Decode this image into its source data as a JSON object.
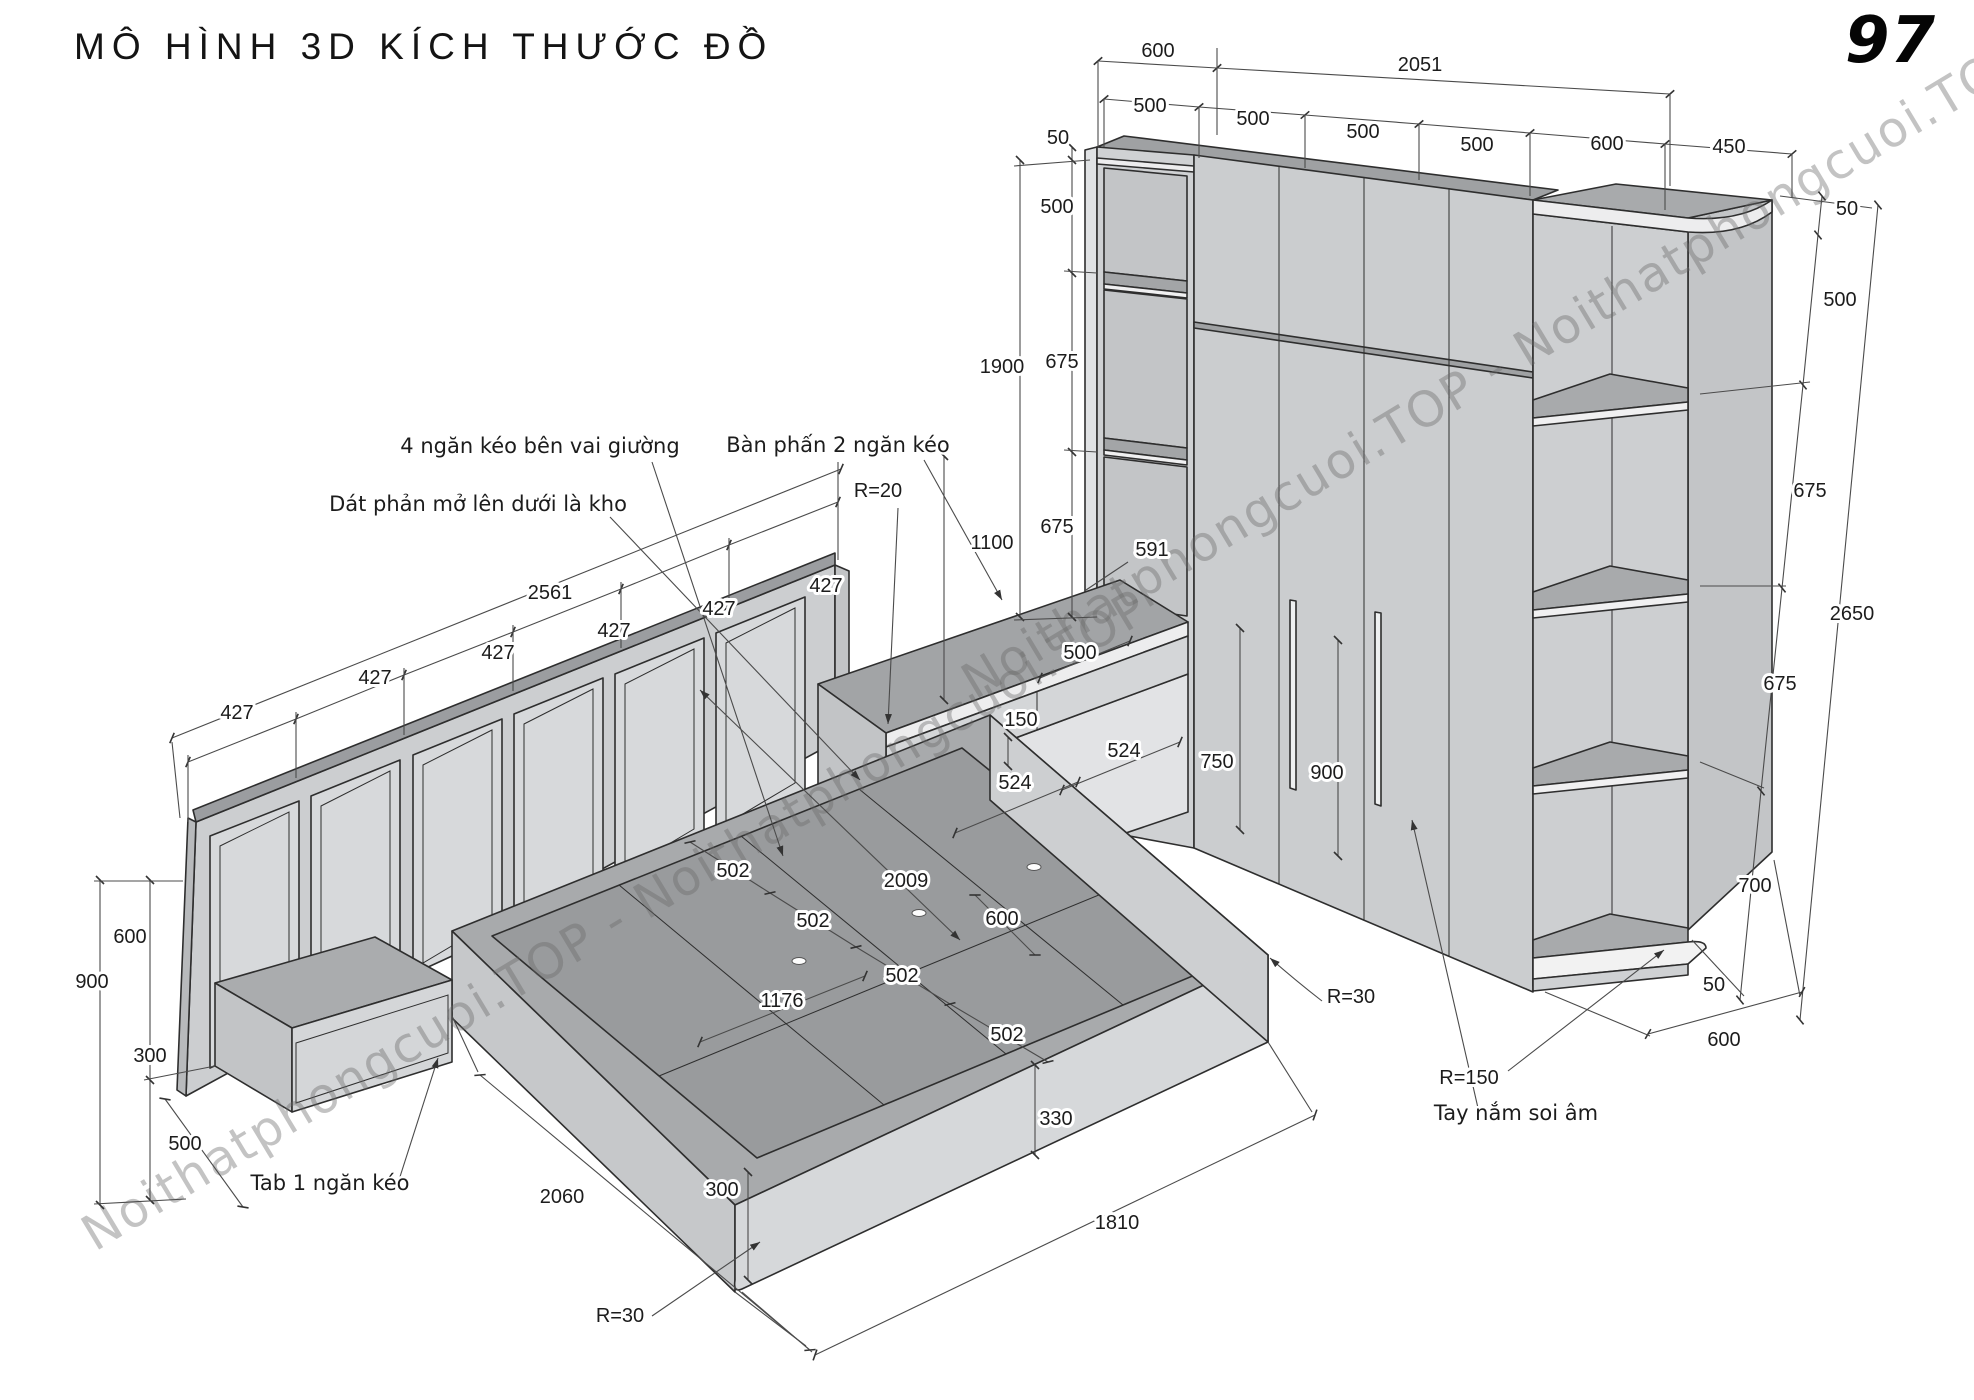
{
  "title": "MÔ HÌNH 3D KÍCH THƯỚC ĐỒ",
  "page_number": "97",
  "watermark": {
    "text": "Noithatphongcuoi.TOP - Noithatphongcuoi.TOP"
  },
  "colors": {
    "line": "#2e2e2e",
    "dim_line": "#4b4b4b",
    "fill_light": "#d6d8da",
    "fill_mid": "#c6c8ca",
    "fill_dark": "#a0a2a4",
    "watermark": "rgba(104,104,104,0.40)"
  },
  "callouts": [
    {
      "text": "4 ngăn kéo bên vai giường"
    },
    {
      "text": "Bàn phấn 2 ngăn kéo"
    },
    {
      "text": "Dát phản mở lên dưới là kho"
    },
    {
      "text": "Tab 1 ngăn kéo"
    },
    {
      "text": "Tay nắm soi âm"
    }
  ],
  "dimensions_mm": {
    "wardrobe": {
      "top_depth": 600,
      "top_width": 2051,
      "door_widths": [
        500,
        500,
        500,
        500
      ],
      "corner_unit": {
        "front": 600,
        "side": 450,
        "edge": 50,
        "shelf_gaps": [
          500,
          675,
          675,
          700
        ],
        "base": 50,
        "bottom_depth": 600,
        "total_height": 2650,
        "radius": "R=150"
      },
      "left_column": {
        "cap": 50,
        "upper": 500,
        "lower_total": 1900,
        "shelf_gaps": [
          675,
          675,
          591
        ]
      },
      "door_handle_heights": [
        750,
        900
      ],
      "handle_note": "Tay nắm soi âm"
    },
    "desk": {
      "name": "Bàn phấn 2 ngăn kéo",
      "height_total": 1100,
      "top_width": 500,
      "drawer_height": 150,
      "depths": [
        524,
        524
      ],
      "corner_radius": "R=20"
    },
    "bed": {
      "length": 2060,
      "width": 1810,
      "slat_gaps": [
        502,
        502,
        502,
        502
      ],
      "inner_width": 1176,
      "side_band": 600,
      "slat_span": 2009,
      "platform_height": 300,
      "foot_height": 330,
      "corner_radius": "R=30",
      "note_storage": "Dát phản mở lên dưới là kho",
      "note_drawers": "4 ngăn kéo bên vai giường"
    },
    "headboard": {
      "width": 2561,
      "panel_widths": [
        427,
        427,
        427,
        427,
        427,
        427
      ],
      "height": 900,
      "panel_height": 600
    },
    "nightstand": {
      "name": "Tab 1 ngăn kéo",
      "height": 300,
      "depth": 500
    }
  },
  "labels": [
    {
      "t": "600",
      "x": 1158,
      "y": 57,
      "cls": "dim"
    },
    {
      "t": "2051",
      "x": 1420,
      "y": 71,
      "cls": "dim"
    },
    {
      "t": "500",
      "x": 1150,
      "y": 112,
      "cls": "dim"
    },
    {
      "t": "500",
      "x": 1253,
      "y": 125,
      "cls": "dim"
    },
    {
      "t": "500",
      "x": 1363,
      "y": 138,
      "cls": "dim"
    },
    {
      "t": "500",
      "x": 1477,
      "y": 151,
      "cls": "dim"
    },
    {
      "t": "600",
      "x": 1607,
      "y": 150,
      "cls": "dim"
    },
    {
      "t": "450",
      "x": 1729,
      "y": 153,
      "cls": "dim"
    },
    {
      "t": "50",
      "x": 1847,
      "y": 215,
      "cls": "dim"
    },
    {
      "t": "50",
      "x": 1058,
      "y": 144,
      "cls": "dim"
    },
    {
      "t": "500",
      "x": 1057,
      "y": 213,
      "cls": "dim"
    },
    {
      "t": "1900",
      "x": 1002,
      "y": 373,
      "cls": "dim"
    },
    {
      "t": "675",
      "x": 1062,
      "y": 368,
      "cls": "dim"
    },
    {
      "t": "675",
      "x": 1057,
      "y": 533,
      "cls": "dim"
    },
    {
      "t": "591",
      "x": 1152,
      "y": 556,
      "cls": "dim"
    },
    {
      "t": "1100",
      "x": 992,
      "y": 549,
      "cls": "dim"
    },
    {
      "t": "R=20",
      "x": 878,
      "y": 497,
      "cls": "dim"
    },
    {
      "t": "500",
      "x": 1080,
      "y": 659,
      "cls": "dim"
    },
    {
      "t": "150",
      "x": 1021,
      "y": 726,
      "cls": "dim"
    },
    {
      "t": "524",
      "x": 1124,
      "y": 757,
      "cls": "dim"
    },
    {
      "t": "524",
      "x": 1015,
      "y": 789,
      "cls": "dim"
    },
    {
      "t": "750",
      "x": 1217,
      "y": 768,
      "cls": "dim"
    },
    {
      "t": "900",
      "x": 1327,
      "y": 779,
      "cls": "dim"
    },
    {
      "t": "500",
      "x": 1840,
      "y": 306,
      "cls": "dim"
    },
    {
      "t": "675",
      "x": 1810,
      "y": 497,
      "cls": "dim"
    },
    {
      "t": "2650",
      "x": 1852,
      "y": 620,
      "cls": "dim"
    },
    {
      "t": "675",
      "x": 1780,
      "y": 690,
      "cls": "dim"
    },
    {
      "t": "700",
      "x": 1755,
      "y": 892,
      "cls": "dim"
    },
    {
      "t": "50",
      "x": 1714,
      "y": 991,
      "cls": "dim"
    },
    {
      "t": "600",
      "x": 1724,
      "y": 1046,
      "cls": "dim"
    },
    {
      "t": "R=30",
      "x": 1351,
      "y": 1003,
      "cls": "dim"
    },
    {
      "t": "R=150",
      "x": 1469,
      "y": 1084,
      "cls": "dim"
    },
    {
      "t": "2561",
      "x": 550,
      "y": 599,
      "cls": "dim"
    },
    {
      "t": "427",
      "x": 237,
      "y": 719,
      "cls": "dim"
    },
    {
      "t": "427",
      "x": 375,
      "y": 684,
      "cls": "dim"
    },
    {
      "t": "427",
      "x": 498,
      "y": 659,
      "cls": "dim"
    },
    {
      "t": "427",
      "x": 614,
      "y": 637,
      "cls": "dim"
    },
    {
      "t": "427",
      "x": 719,
      "y": 615,
      "cls": "dim"
    },
    {
      "t": "427",
      "x": 826,
      "y": 592,
      "cls": "dim"
    },
    {
      "t": "600",
      "x": 130,
      "y": 943,
      "cls": "dim"
    },
    {
      "t": "900",
      "x": 92,
      "y": 988,
      "cls": "dim"
    },
    {
      "t": "300",
      "x": 150,
      "y": 1062,
      "cls": "dim"
    },
    {
      "t": "500",
      "x": 185,
      "y": 1150,
      "cls": "dim"
    },
    {
      "t": "502",
      "x": 733,
      "y": 877,
      "cls": "dim"
    },
    {
      "t": "502",
      "x": 813,
      "y": 927,
      "cls": "dim"
    },
    {
      "t": "502",
      "x": 902,
      "y": 982,
      "cls": "dim"
    },
    {
      "t": "502",
      "x": 1007,
      "y": 1041,
      "cls": "dim"
    },
    {
      "t": "1176",
      "x": 782,
      "y": 1007,
      "cls": "dim"
    },
    {
      "t": "2009",
      "x": 906,
      "y": 887,
      "cls": "dim"
    },
    {
      "t": "600",
      "x": 1002,
      "y": 925,
      "cls": "dim"
    },
    {
      "t": "330",
      "x": 1056,
      "y": 1125,
      "cls": "dim"
    },
    {
      "t": "300",
      "x": 722,
      "y": 1196,
      "cls": "dim"
    },
    {
      "t": "2060",
      "x": 562,
      "y": 1203,
      "cls": "dim"
    },
    {
      "t": "1810",
      "x": 1117,
      "y": 1229,
      "cls": "dim"
    },
    {
      "t": "R=30",
      "x": 620,
      "y": 1322,
      "cls": "dim"
    },
    {
      "t": "4 ngăn kéo bên vai giường",
      "x": 540,
      "y": 453,
      "cls": "note"
    },
    {
      "t": "Bàn phấn 2 ngăn kéo",
      "x": 838,
      "y": 452,
      "cls": "note"
    },
    {
      "t": "Dát phản mở lên dưới là kho",
      "x": 478,
      "y": 511,
      "cls": "note"
    },
    {
      "t": "Tab 1 ngăn kéo",
      "x": 330,
      "y": 1190,
      "cls": "note"
    },
    {
      "t": "Tay nắm soi âm",
      "x": 1516,
      "y": 1120,
      "cls": "note"
    }
  ],
  "watermarks": [
    {
      "x": 95,
      "y": 1252,
      "rot": -31
    },
    {
      "x": 975,
      "y": 700,
      "rot": -31
    }
  ]
}
